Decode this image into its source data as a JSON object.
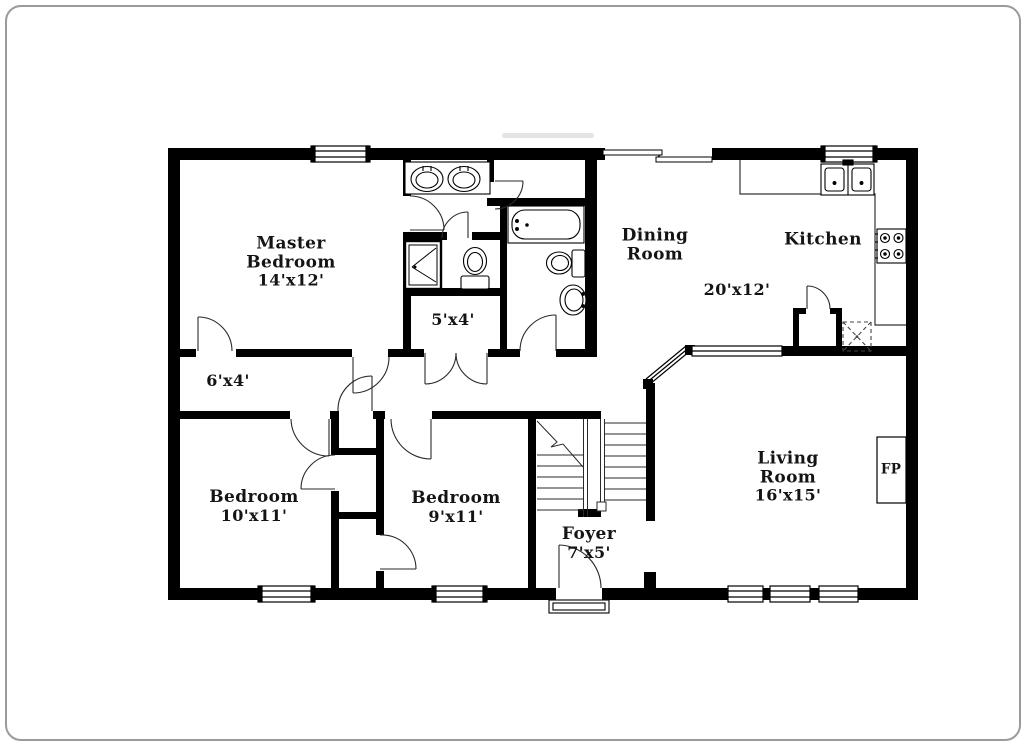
{
  "plan": {
    "colors": {
      "wall": "#000000",
      "background": "#ffffff",
      "fixture_line": "#1a1a1a"
    },
    "rooms": {
      "master_bedroom": {
        "name": "Master Bedroom",
        "dims": "14'x12'"
      },
      "closet_6x4": {
        "dims": "6'x4'"
      },
      "closet_5x4": {
        "dims": "5'x4'"
      },
      "bedroom_left": {
        "name": "Bedroom",
        "dims": "10'x11'"
      },
      "bedroom_mid": {
        "name": "Bedroom",
        "dims": "9'x11'"
      },
      "foyer": {
        "name": "Foyer",
        "dims": "7'x5'"
      },
      "dining": {
        "name": "Dining Room",
        "dims": "20'x12'"
      },
      "kitchen": {
        "name": "Kitchen"
      },
      "living": {
        "name": "Living Room",
        "dims": "16'x15'"
      },
      "fireplace": {
        "abbr": "FP"
      }
    }
  }
}
